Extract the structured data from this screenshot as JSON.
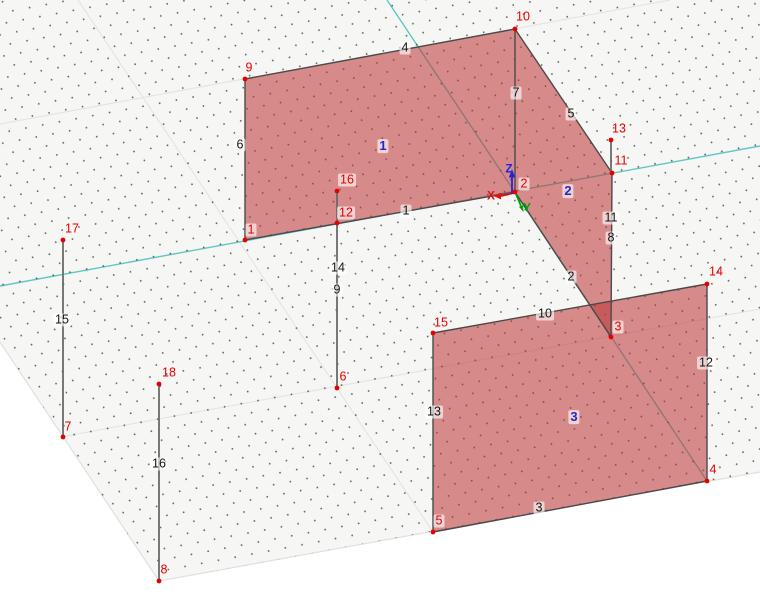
{
  "viewport": {
    "width": 760,
    "height": 610
  },
  "colors": {
    "plane_fill": "#f6f6f4",
    "dot": "#4a4a4a",
    "grid_line": "#e2e2e0",
    "boundary": "#e0e0de",
    "axis_teal": "#5fc8c6",
    "surface_fill": "rgba(187,51,51,0.55)",
    "edge": "#4a4a4a",
    "free_line": "#6a6a6a",
    "node": "#e60000",
    "node_label": "#e60000",
    "line_label": "#141414",
    "surface_label": "#2525cc",
    "label_box": "rgba(255,255,255,0.62)"
  },
  "grid": {
    "plane_polygon": [
      [
        0,
        0
      ],
      [
        760,
        0
      ],
      [
        760,
        472
      ],
      [
        159,
        581
      ],
      [
        0,
        342
      ]
    ],
    "boundary": [
      [
        0,
        342
      ],
      [
        159,
        581
      ],
      [
        760,
        472
      ]
    ],
    "major_lines": [
      [
        [
          0,
          124
        ],
        [
          670,
          0
        ]
      ],
      [
        [
          0,
          448
        ],
        [
          760,
          309
        ]
      ],
      [
        [
          78,
          0
        ],
        [
          433,
          532
        ]
      ]
    ],
    "axis_x_line": [
      [
        0,
        286
      ],
      [
        760,
        146
      ]
    ],
    "axis_y_line": [
      [
        387,
        0
      ],
      [
        707,
        481
      ]
    ]
  },
  "surfaces": [
    {
      "id": "1",
      "points": [
        [
          245,
          79
        ],
        [
          515,
          29
        ],
        [
          515,
          192
        ],
        [
          245,
          240
        ]
      ],
      "label": {
        "text": "1",
        "x": 383,
        "y": 146
      }
    },
    {
      "id": "2",
      "points": [
        [
          515,
          29
        ],
        [
          612,
          173
        ],
        [
          611,
          337
        ],
        [
          515,
          192
        ]
      ],
      "label": {
        "text": "2",
        "x": 568,
        "y": 191
      }
    },
    {
      "id": "3",
      "points": [
        [
          433,
          333
        ],
        [
          707,
          284
        ],
        [
          707,
          481
        ],
        [
          433,
          532
        ]
      ],
      "label": {
        "text": "3",
        "x": 574,
        "y": 417
      }
    }
  ],
  "model_lines": [
    {
      "id": "4",
      "points": [
        [
          245,
          79
        ],
        [
          515,
          29
        ]
      ]
    },
    {
      "id": "6",
      "points": [
        [
          245,
          79
        ],
        [
          245,
          240
        ]
      ]
    },
    {
      "id": "1",
      "points": [
        [
          245,
          240
        ],
        [
          515,
          192
        ]
      ]
    },
    {
      "id": "7",
      "points": [
        [
          515,
          29
        ],
        [
          515,
          192
        ]
      ]
    },
    {
      "id": "5",
      "points": [
        [
          515,
          29
        ],
        [
          612,
          173
        ]
      ]
    },
    {
      "id": "11-8",
      "points": [
        [
          612,
          173
        ],
        [
          611,
          337
        ]
      ]
    },
    {
      "id": "2",
      "points": [
        [
          515,
          192
        ],
        [
          611,
          337
        ]
      ]
    },
    {
      "id": "10",
      "points": [
        [
          433,
          333
        ],
        [
          707,
          284
        ]
      ]
    },
    {
      "id": "13",
      "points": [
        [
          433,
          333
        ],
        [
          433,
          532
        ]
      ]
    },
    {
      "id": "3",
      "points": [
        [
          433,
          532
        ],
        [
          707,
          481
        ]
      ]
    },
    {
      "id": "12",
      "points": [
        [
          707,
          284
        ],
        [
          707,
          481
        ]
      ]
    }
  ],
  "free_lines": [
    {
      "id": "15",
      "points": [
        [
          63,
          240
        ],
        [
          63,
          437
        ]
      ]
    },
    {
      "id": "16",
      "points": [
        [
          159,
          384
        ],
        [
          159,
          581
        ]
      ]
    },
    {
      "id": "14-9",
      "points": [
        [
          337,
          191
        ],
        [
          337,
          388
        ]
      ]
    },
    {
      "id": "13-stub",
      "points": [
        [
          611,
          140
        ],
        [
          611,
          173
        ]
      ]
    }
  ],
  "nodes": [
    {
      "id": "1",
      "x": 245,
      "y": 240,
      "lx": 251,
      "ly": 230,
      "boxed": true
    },
    {
      "id": "2",
      "x": 515,
      "y": 192,
      "lx": 524,
      "ly": 184,
      "boxed": true
    },
    {
      "id": "3",
      "x": 611,
      "y": 337,
      "lx": 618,
      "ly": 327,
      "boxed": true
    },
    {
      "id": "4",
      "x": 707,
      "y": 481,
      "lx": 713,
      "ly": 470,
      "boxed": false
    },
    {
      "id": "5",
      "x": 433,
      "y": 532,
      "lx": 439,
      "ly": 521,
      "boxed": true
    },
    {
      "id": "6",
      "x": 337,
      "y": 388,
      "lx": 343,
      "ly": 377,
      "boxed": false
    },
    {
      "id": "7",
      "x": 63,
      "y": 437,
      "lx": 68,
      "ly": 427,
      "boxed": false
    },
    {
      "id": "8",
      "x": 159,
      "y": 581,
      "lx": 164,
      "ly": 570,
      "boxed": false
    },
    {
      "id": "9",
      "x": 245,
      "y": 79,
      "lx": 249,
      "ly": 68,
      "boxed": false
    },
    {
      "id": "10",
      "x": 515,
      "y": 29,
      "lx": 523,
      "ly": 17,
      "boxed": false
    },
    {
      "id": "11",
      "x": 612,
      "y": 173,
      "lx": 621,
      "ly": 161,
      "boxed": false
    },
    {
      "id": "12",
      "x": 337,
      "y": 223,
      "lx": 346,
      "ly": 213,
      "boxed": true
    },
    {
      "id": "13",
      "x": 611,
      "y": 140,
      "lx": 619,
      "ly": 129,
      "boxed": false
    },
    {
      "id": "14",
      "x": 707,
      "y": 284,
      "lx": 716,
      "ly": 272,
      "boxed": false
    },
    {
      "id": "15",
      "x": 433,
      "y": 333,
      "lx": 441,
      "ly": 323,
      "boxed": false
    },
    {
      "id": "16",
      "x": 337,
      "y": 191,
      "lx": 347,
      "ly": 180,
      "boxed": true
    },
    {
      "id": "17",
      "x": 63,
      "y": 240,
      "lx": 72,
      "ly": 229,
      "boxed": false
    },
    {
      "id": "18",
      "x": 159,
      "y": 384,
      "lx": 169,
      "ly": 373,
      "boxed": false
    }
  ],
  "line_labels": [
    {
      "id": "1",
      "x": 406,
      "y": 211
    },
    {
      "id": "2",
      "x": 571,
      "y": 277
    },
    {
      "id": "3",
      "x": 539,
      "y": 508
    },
    {
      "id": "4",
      "x": 405,
      "y": 48
    },
    {
      "id": "5",
      "x": 571,
      "y": 114
    },
    {
      "id": "6",
      "x": 240,
      "y": 145
    },
    {
      "id": "7",
      "x": 516,
      "y": 93
    },
    {
      "id": "8",
      "x": 611,
      "y": 238
    },
    {
      "id": "9",
      "x": 337,
      "y": 290
    },
    {
      "id": "10",
      "x": 545,
      "y": 314
    },
    {
      "id": "11",
      "x": 611,
      "y": 218
    },
    {
      "id": "12",
      "x": 706,
      "y": 363
    },
    {
      "id": "13",
      "x": 434,
      "y": 412
    },
    {
      "id": "14",
      "x": 338,
      "y": 268
    },
    {
      "id": "15",
      "x": 62,
      "y": 320
    },
    {
      "id": "16",
      "x": 159,
      "y": 464
    }
  ],
  "origin_triad": {
    "x": {
      "label": "X",
      "color": "#e11010",
      "line": [
        514,
        193,
        501,
        196
      ],
      "head": "501,192.6 501,199.4 493.5,196",
      "lx": 491,
      "ly": 196
    },
    "y": {
      "label": "Y",
      "color": "#00a400",
      "line": [
        516,
        194,
        521,
        206
      ],
      "head": "523.1,205.2 518.9,206.8 523.5,212",
      "lx": 527,
      "ly": 208
    },
    "z": {
      "label": "Z",
      "color": "#2424dd",
      "line": [
        512,
        194,
        512,
        177
      ],
      "head": "508.8,177.5 515.2,177.5 512,169",
      "lx": 509,
      "ly": 169
    }
  }
}
